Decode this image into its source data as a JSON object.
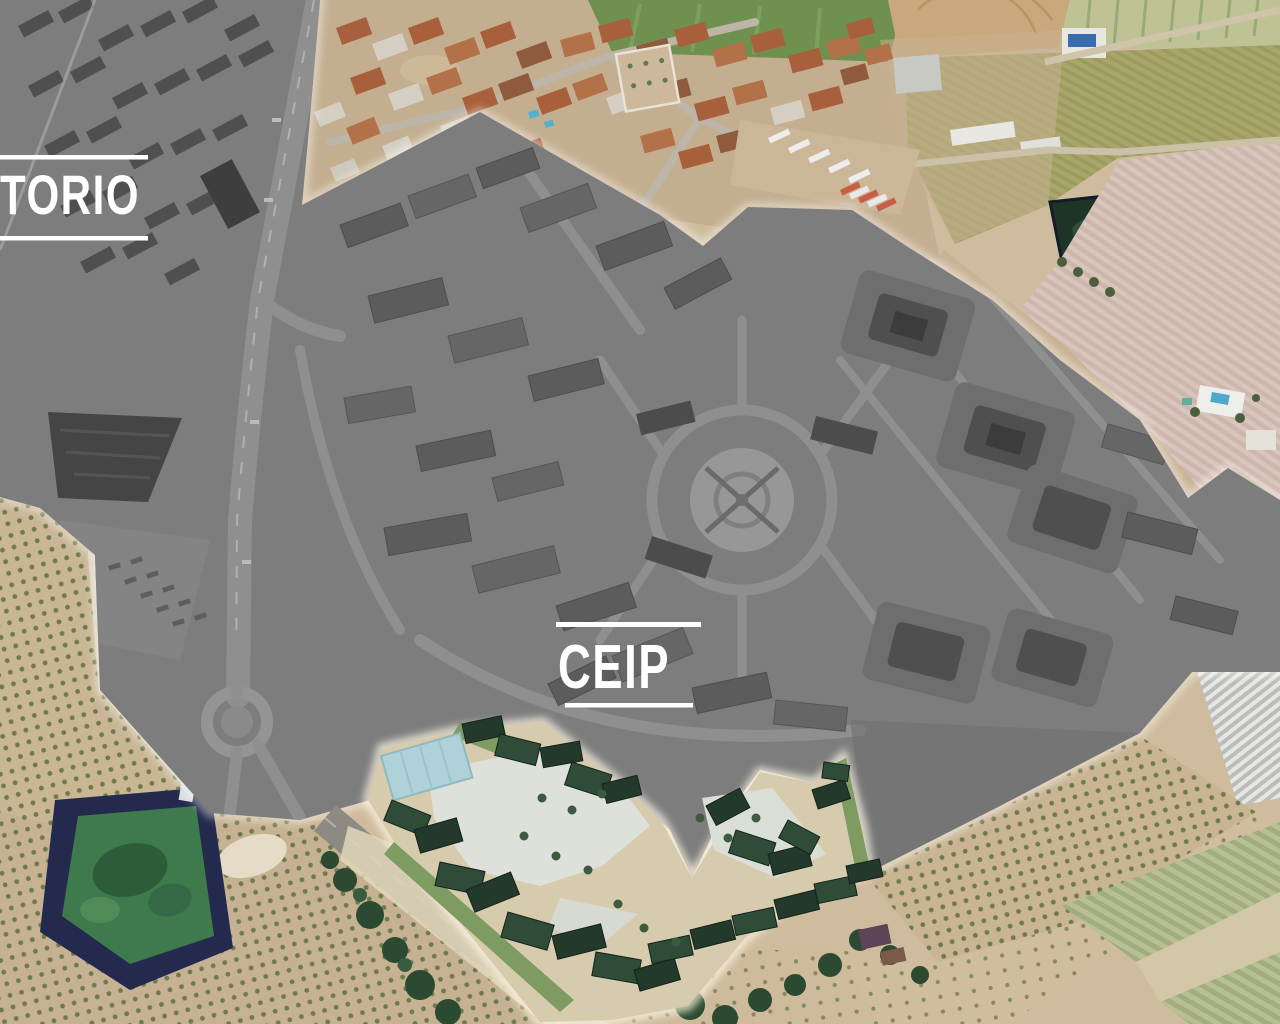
{
  "map": {
    "description": "Aerial masterplan photo: grey-masked residential development surrounded by farmland, with highlighted CEIP school site",
    "labels": {
      "torio": {
        "text": "TORIO"
      },
      "ceip": {
        "text": "CEIP"
      }
    },
    "colors": {
      "label_text": "#ffffff",
      "label_line": "#ffffff",
      "masked_area": "#7d7d7d",
      "farmland_base": "#cfbc9e",
      "school_roof_green": "#22392b",
      "school_canopy_blue": "#aed2d8",
      "school_courtyard": "#dde1da",
      "reservoir_rim": "#232a4d",
      "reservoir_water": "#3e7a4c",
      "village_roof_terracotta": "#a8603c",
      "olive_field": "#a8a66a",
      "pink_striped_field": "#cdb6ae",
      "sports_field_green": "#70904f"
    }
  }
}
